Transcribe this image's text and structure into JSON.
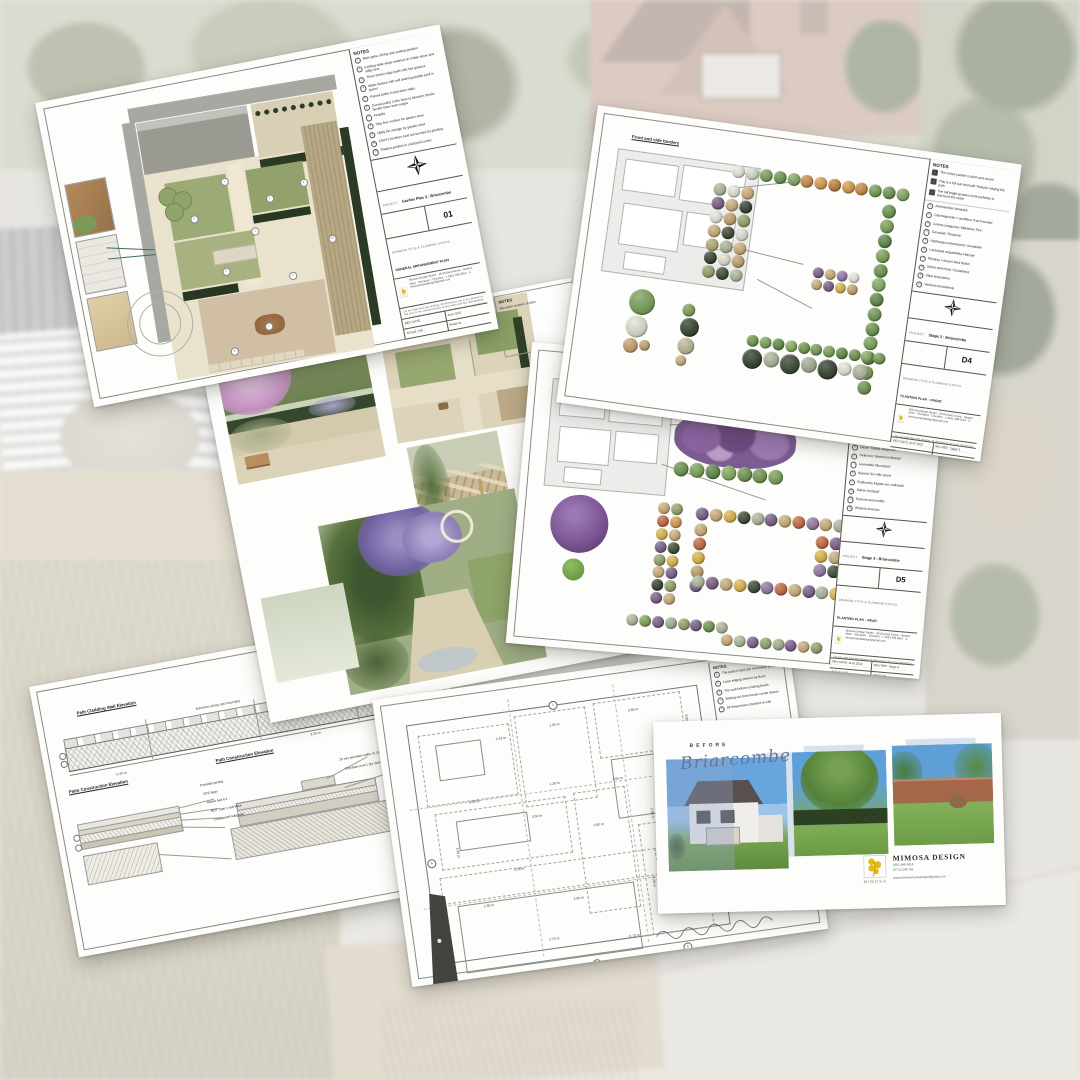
{
  "branding": {
    "name": "MIMOSA",
    "design_title": "MIMOSA DESIGN",
    "phone1": "0161 496 0814",
    "phone2": "07712 246 781",
    "email": "www.mimosamariadesign@gmail.com",
    "address_lines": "Mimosa Design Studio · 28 Orchard Grove · Heaton Moor · Stockport · Cheshire · t: 0161 496 0814 · e: mimosamariadesign@gmail.com",
    "logo_color": "#e5bb13"
  },
  "common": {
    "notes_title": "NOTES",
    "project_label": "PROJECT",
    "drawing_label": "DRAWING TITLE & PLANNING STATUS",
    "disclaimer": "Do not scale from this drawing. All dimensions are to be checked on site prior to the commencement of any works and any discrepancies reported to the designer immediately. This drawing is the copyright of Mimosa Design and must not be reproduced, copied or altered without written consent. All levels, dimensions and specifications are indicative only and are subject to final site survey. Underground services must be located before any excavation works begin. All materials to be agreed with the client before ordering."
  },
  "sheet_plan": {
    "notes": [
      "Main patio, dining and seating position",
      "Existing slate steps retained on Indian stone and utility bins",
      "Three timber edge beds with low grasses",
      "Water feature with self draining pebble pool in gravel",
      "Raised paths in porcelain slabs",
      "Curved paths in the lawn to blossom shrubs beside lower lawn edges",
      "Pergola",
      "Step free surface for garden store",
      "Utility bin storage by garden shed",
      "Client's furniture seat surrounded by planting",
      "Shaded position in courtyard corner"
    ],
    "project": "Garden Plan 3 : Briarcombe",
    "sheet_no": "01",
    "drawing_title": "GENERAL ARRANGEMENT PLAN",
    "rows": [
      "REV. DATE",
      "AUG 2022",
      "SCALE 1:50",
      "PAGE 01"
    ],
    "markers": [
      {
        "x": 108,
        "y": 96,
        "t": "1",
        "cls": "mk"
      },
      {
        "x": 150,
        "y": 120,
        "t": "2",
        "cls": "mk"
      },
      {
        "x": 72,
        "y": 128,
        "t": "3",
        "cls": "mk"
      },
      {
        "x": 130,
        "y": 150,
        "t": "4",
        "cls": "mk"
      },
      {
        "x": 95,
        "y": 185,
        "t": "5",
        "cls": "mk"
      },
      {
        "x": 160,
        "y": 200,
        "t": "6",
        "cls": "mk"
      },
      {
        "x": 128,
        "y": 246,
        "t": "7",
        "cls": "mk"
      },
      {
        "x": 90,
        "y": 265,
        "t": "8",
        "cls": "mk"
      },
      {
        "x": 186,
        "y": 110,
        "t": "9",
        "cls": "mk"
      },
      {
        "x": 205,
        "y": 170,
        "t": "10",
        "cls": "mk"
      }
    ]
  },
  "sheet_d4": {
    "area_label": "Front and side borders",
    "checks": [
      "The colour palette is plum and cream",
      "This is a full sun bed with 'Hidcote' edging the path",
      "The tall bright grasses work perfectly to surround the seats"
    ],
    "plants": [
      "Amelanchier lamarckii",
      "Calamagrostis × acutiflora 'Karl Foerster'",
      "Cornus sanguinea 'Midwinter Fire'",
      "Geranium 'Rozanne'",
      "Hydrangea arborescens 'Annabelle'",
      "Lavandula angustifolia 'Hidcote'",
      "Photinia × fraseri 'Red Robin'",
      "Salvia nemorosa 'Caradonna'",
      "Stipa tenuissima",
      "Verbena bonariensis"
    ],
    "project": "Stage 3 : Briarcombe",
    "sheet_no": "D4",
    "drawing_title": "PLANTING PLAN – FRONT",
    "rows": [
      "REV DATE: AUG 2022",
      "REV REF: Stage 3",
      "SCALE 1:50",
      "PAGE D4"
    ],
    "byline": "By Laura Gibelle · Mimosa Design Ltd"
  },
  "sheet_renders": {
    "notes_title": "NOTES",
    "note": "Elevation renders of plan"
  },
  "sheet_d5": {
    "area_label": "Rear borders – far garden borders",
    "checks": [
      "The colour palette is plum, amber and gold",
      "Avoid planting too close to the lawn edge"
    ],
    "plants": [
      "Achillea 'Terracotta'",
      "Allium 'Purple Sensation'",
      "Echinacea purpurea 'Magnus'",
      "Erigeron karvinskianus",
      "Geum 'Totally Tangerine'",
      "Helenium 'Moerheim Beauty'",
      "Lavandula 'Munstead'",
      "Nepeta 'Six Hills Giant'",
      "Rudbeckia fulgida var. sullivantii",
      "Salvia 'Amistad'",
      "Sesleria autumnalis",
      "Wisteria sinensis"
    ],
    "project": "Stage 3 : Briarcombe",
    "sheet_no": "D5",
    "drawing_title": "PLANTING PLAN – REAR",
    "rows": [
      "REV DATE: AUG 2022",
      "REV REF: Stage 3",
      "SCALE 1:50",
      "PAGE D5"
    ],
    "byline": "By Laura Gibelle · Mimosa Design Ltd"
  },
  "sheet_construction": {
    "notes_title": "NOTES",
    "notes": [
      "Indian sandstone 'Raj Green' riven slabs",
      "Arranged with 10 mm pointed joints",
      "MOT Type 1 at a depth of 150 mm",
      "All found within 5 mm tolerance when laid"
    ],
    "heading_wall": "Path Cladding Wall Elevation",
    "heading_patio": "Patio Construction Elevation",
    "heading_path": "Path Construction Elevation",
    "strip_labels": [
      {
        "x": 160,
        "y": 50,
        "t": "Elevation along rear boundary"
      },
      {
        "x": 70,
        "y": 100,
        "t": "5.40 m"
      },
      {
        "x": 268,
        "y": 96,
        "t": "3.20 m"
      }
    ],
    "left_labels": [
      {
        "x": 150,
        "y": 126,
        "t": "Porcelain paving",
        "cls": "lbl"
      },
      {
        "x": 152,
        "y": 135,
        "t": "DPC layer",
        "cls": "lbl"
      },
      {
        "x": 154,
        "y": 144,
        "t": "Mortar bed 6:1",
        "cls": "lbl"
      },
      {
        "x": 156,
        "y": 153,
        "t": "MOT Type 1 sub-base",
        "cls": "lbl"
      },
      {
        "x": 158,
        "y": 162,
        "t": "Compacted subgrade",
        "cls": "lbl"
      }
    ],
    "right_labels": [
      {
        "x": 292,
        "y": 126,
        "t": "20 mm porcelain slabs, 8–10 mm joints",
        "cls": "lbl"
      },
      {
        "x": 296,
        "y": 136,
        "t": "Porcelain on 6:1 dry mortar bedding",
        "cls": "lbl"
      }
    ]
  },
  "sheet_setting_out": {
    "notes_title": "NOTES",
    "notes": [
      "The patio is laid 150 mm below DPC",
      "Lawn edging steel to be flush",
      "The wall follows existing levels",
      "Setting out from house corner datum",
      "All dimensions checked on site"
    ],
    "dims": [
      {
        "x": 95,
        "y": 36,
        "t": "2.43 m"
      },
      {
        "x": 150,
        "y": 30,
        "t": "1.50 m"
      },
      {
        "x": 230,
        "y": 26,
        "t": "3.65 m"
      },
      {
        "x": 289,
        "y": 40,
        "t": "0.65 m",
        "r": 90
      },
      {
        "x": 60,
        "y": 95,
        "t": "5.43 m"
      },
      {
        "x": 142,
        "y": 88,
        "t": "1.26 m"
      },
      {
        "x": 205,
        "y": 92,
        "t": "2.65 m"
      },
      {
        "x": 120,
        "y": 118,
        "t": "4.50 m"
      },
      {
        "x": 44,
        "y": 140,
        "t": "1.90 m",
        "r": 90
      },
      {
        "x": 180,
        "y": 135,
        "t": "0.90 m"
      },
      {
        "x": 242,
        "y": 128,
        "t": "2.08 m",
        "r": 90
      },
      {
        "x": 95,
        "y": 168,
        "t": "3.08 m"
      },
      {
        "x": 60,
        "y": 200,
        "t": "1.35 m"
      },
      {
        "x": 150,
        "y": 205,
        "t": "2.90 m"
      },
      {
        "x": 234,
        "y": 196,
        "t": "1.08 m",
        "r": 90
      },
      {
        "x": 120,
        "y": 242,
        "t": "2.75 m"
      },
      {
        "x": 200,
        "y": 250,
        "t": "0.75 m"
      },
      {
        "x": 280,
        "y": 228,
        "t": "1.60 m",
        "r": 90
      }
    ],
    "refs": [
      {
        "x": 10,
        "y": 148,
        "t": "A",
        "cls": "ref"
      },
      {
        "x": 152,
        "y": 8,
        "t": "1",
        "cls": "ref"
      },
      {
        "x": 312,
        "y": 78,
        "t": "2",
        "cls": "ref"
      },
      {
        "x": 298,
        "y": 186,
        "t": "3",
        "cls": "ref"
      },
      {
        "x": 160,
        "y": 270,
        "t": "4",
        "cls": "ref"
      },
      {
        "x": 252,
        "y": 266,
        "t": "5",
        "cls": "ref"
      }
    ]
  },
  "sheet_before": {
    "before_label": "BEFORE",
    "project_name": "Briarcombe"
  },
  "clusters": {
    "d4": {
      "hedge_top": {
        "size": 13,
        "colors": [
          "#e7e9de",
          "#d4dcc4",
          "#6d9747",
          "#5d8a3b",
          "#76a150",
          "#c67f2d",
          "#d6923e",
          "#b9732a",
          "#d6923e",
          "#c67f2d",
          "#679243",
          "#5d8a3b",
          "#76a150"
        ]
      },
      "hedge_right": {
        "size": 14,
        "colors": [
          "#5f8a3c",
          "#6f9a47",
          "#4e7c31",
          "#6f9a47",
          "#5f8a3c",
          "#7ba552",
          "#4e7c31",
          "#659043",
          "#5f8a3c",
          "#6f9a47",
          "#4e7c31",
          "#659043",
          "#5f8a3c"
        ]
      },
      "bed_left": {
        "size": 13,
        "colors": [
          "#a9b394",
          "#e6e8dc",
          "#c8a96e",
          "#6c4f7d",
          "#c8a96e",
          "#1f2d18",
          "#e6e8dc",
          "#bb9a5f",
          "#8a9a5b",
          "#c8a96e",
          "#26351d",
          "#dfe3d2",
          "#b0a36b",
          "#a9b394",
          "#c8a96e",
          "#1f2d18",
          "#dfe3d2",
          "#bb9a5f",
          "#8a9a5b",
          "#26351d",
          "#a9b394"
        ]
      },
      "bed_mid": {
        "size": 11,
        "colors": [
          "#6c4f7d",
          "#c8a96e",
          "#8a6b9c",
          "#e6e8dc",
          "#c8a96e",
          "#6c4f7d",
          "#d9b13b",
          "#bb9a5f"
        ]
      },
      "bed_bottom_hedge": {
        "size": 12,
        "colors": [
          "#5f8a3c",
          "#6f9a47",
          "#4e7c31",
          "#7ba552",
          "#5f8a3c",
          "#659043",
          "#6f9a47",
          "#4e7c31",
          "#5f8a3c",
          "#7ba552",
          "#659043"
        ]
      },
      "bed_bottom_mix": {
        "size": 14,
        "colors": [
          {
            "c": "#1f2d18",
            "s": 20
          },
          {
            "c": "#a9b394",
            "s": 16
          },
          {
            "c": "#26351d",
            "s": 20
          },
          {
            "c": "#9aa98b",
            "s": 16
          },
          {
            "c": "#1f2d18",
            "s": 20
          },
          {
            "c": "#e6e8dc",
            "s": 14
          },
          {
            "c": "#a9b394",
            "s": 16
          }
        ]
      },
      "lone_a": {
        "size": 14,
        "colors": [
          {
            "c": "#6f9a4a",
            "s": 26
          },
          {
            "c": "#dfe3d2",
            "s": 22
          },
          {
            "c": "#c49a5e",
            "s": 15
          },
          {
            "c": "#bb9a5f",
            "s": 11
          }
        ]
      },
      "lone_b": {
        "size": 14,
        "colors": [
          {
            "c": "#6f9a47",
            "s": 13
          },
          {
            "c": "#222f1b",
            "s": 19
          },
          {
            "c": "#b9b58f",
            "s": 17
          },
          {
            "c": "#c8a96e",
            "s": 11
          }
        ]
      }
    },
    "d5": {
      "hedge_under": {
        "size": 15,
        "colors": [
          "#5f8a3c",
          "#6f9a47",
          "#4e7c31",
          "#7ba552",
          "#5f8a3c",
          "#659043",
          "#6f9a47"
        ]
      },
      "strip": {
        "size": 12,
        "colors": [
          "#c8a96e",
          "#8a9a5b",
          "#c05a2e",
          "#d6923e",
          "#d9b13b",
          "#c8a96e",
          "#6c4f7d",
          "#26351d",
          "#8a9a5b",
          "#d9b13b",
          "#c8a96e",
          "#6c4f7d",
          "#1f2d18",
          "#8a9a5b",
          "#6c4f7d",
          "#c8a96e"
        ]
      },
      "bed_top": {
        "size": 13,
        "colors": [
          "#6c4f7d",
          "#c8a96e",
          "#d9b13b",
          "#26351d",
          "#a9b394",
          "#6c4f7d",
          "#c8a96e",
          "#c05a2e",
          "#8a6b9c",
          "#c8a96e",
          "#a9b394"
        ]
      },
      "bed_leftcol": {
        "size": 13,
        "colors": [
          "#c8a96e",
          "#c05a2e",
          "#d9b13b",
          "#bb9a5f",
          "#6c4f7d"
        ]
      },
      "bed_bottom": {
        "size": 13,
        "colors": [
          "#a9b394",
          "#6c4f7d",
          "#c8a96e",
          "#d9b13b",
          "#26351d",
          "#8a6b9c",
          "#c05a2e",
          "#c8a96e",
          "#6c4f7d",
          "#a9b394",
          "#d9b13b"
        ]
      },
      "bed_right": {
        "size": 13,
        "colors": [
          "#c05a2e",
          "#6c4f7d",
          "#d9b13b",
          "#c8a96e",
          "#8a6b9c",
          "#26351d"
        ]
      },
      "row1": {
        "size": 12,
        "colors": [
          "#a9b394",
          "#6f9a47",
          "#6c4f7d",
          "#9aa98b",
          "#8a9a5b",
          "#6c4f7d",
          "#5f8a3c",
          "#a9b394"
        ]
      },
      "row2": {
        "size": 12,
        "colors": [
          "#c8a96e",
          "#a9b394",
          "#6c4f7d",
          "#8a9a5b",
          "#9aa98b",
          "#6c4f7d",
          "#c8a96e",
          "#8a9a5b"
        ]
      }
    }
  }
}
